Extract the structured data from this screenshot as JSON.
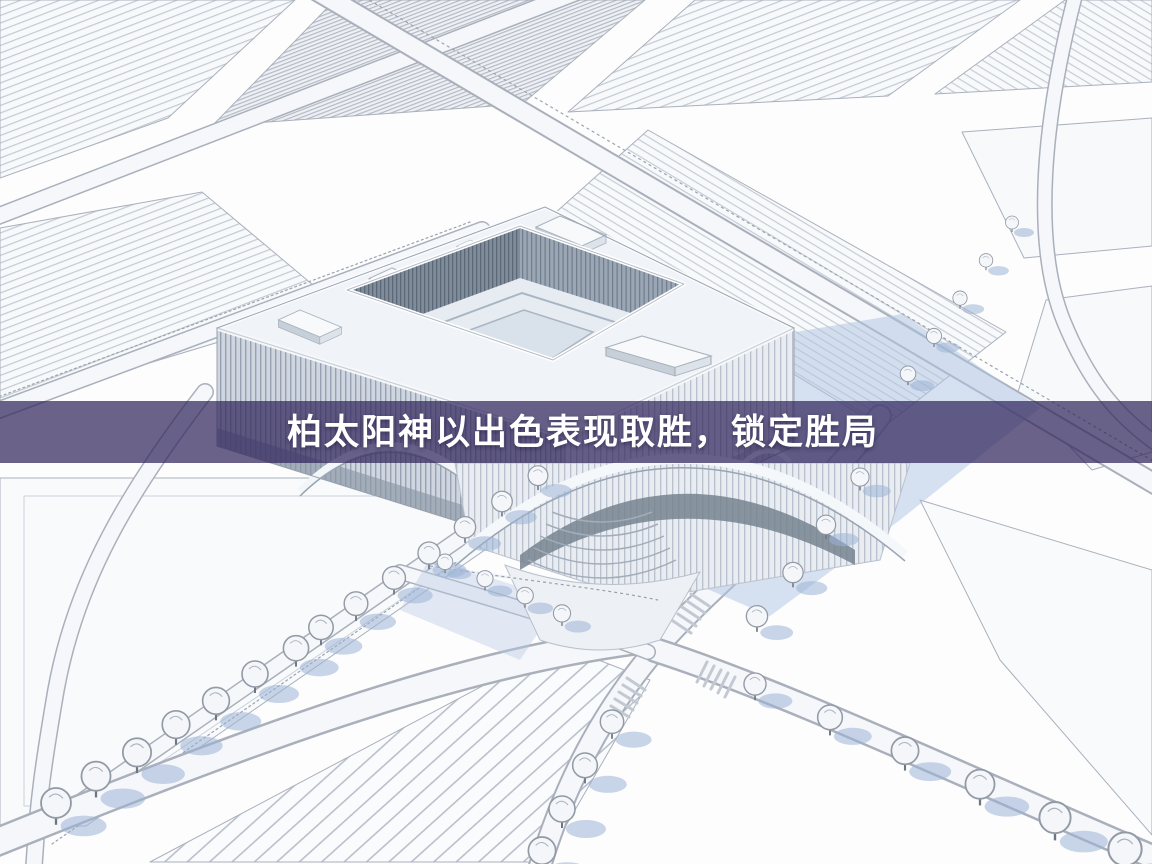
{
  "banner": {
    "headline": "柏太阳神以出色表现取胜，锁定胜局",
    "background_color": "#31265B",
    "overlay_opacity": 0.72,
    "text_color": "#FFFFFF"
  },
  "scene": {
    "subject": "aerial-architectural-render-of-courtyard-building-with-farmland-roads-and-trees",
    "palette": {
      "background": "#FDFDFE",
      "roof": "#F0F3F7",
      "facade_light": "#E9EDF2",
      "facade_dark": "#CDD5DE",
      "louver_line": "#94A1B1",
      "inner_wall": "#7F8C9C",
      "field_line": "#C3CAD4",
      "road_fill": "#F5F7FA",
      "road_edge": "#A9B0BB",
      "tree_canopy": "#F4F6F9",
      "tree_outline": "#929AA6",
      "shadow_blue": "#AEC3E2"
    }
  }
}
